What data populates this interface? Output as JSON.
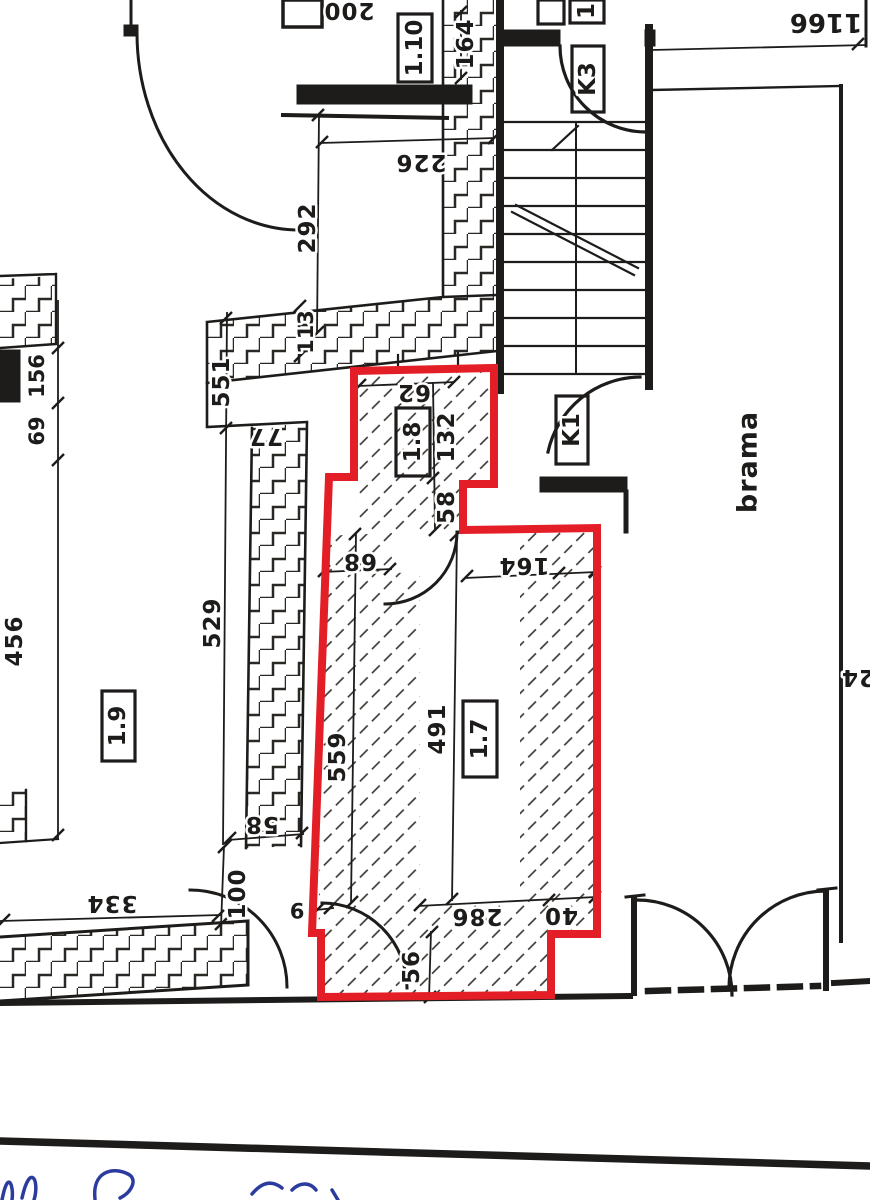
{
  "labels": {
    "room_110": "1.10",
    "room_18": "1.8",
    "room_17": "1.7",
    "room_19": "1.9",
    "stair_k3": "K3",
    "stair_k1": "K1",
    "partial_room": "1",
    "gate": "brama"
  },
  "dims": {
    "d200": "200",
    "d1166": "1166",
    "d164_top": "164",
    "d226": "226",
    "d292": "292",
    "d113": "113",
    "d551": "551",
    "d77": "77",
    "d156": "156",
    "d69": "69",
    "d62": "62",
    "d132": "132",
    "d58_niche": "58",
    "d68": "68",
    "d164_inner": "164",
    "d456": "456",
    "d529": "529",
    "d559": "559",
    "d491": "491",
    "d58_lower": "58",
    "d100": "100",
    "d334": "334",
    "d9": "9",
    "d286": "286",
    "d40": "40",
    "d56": "56",
    "d24_edge": "24"
  },
  "colors": {
    "highlight_red": "#e41e26",
    "ink": "#1e1c1a",
    "handwriting_blue": "#2b3b9e",
    "paper": "#ffffff"
  }
}
